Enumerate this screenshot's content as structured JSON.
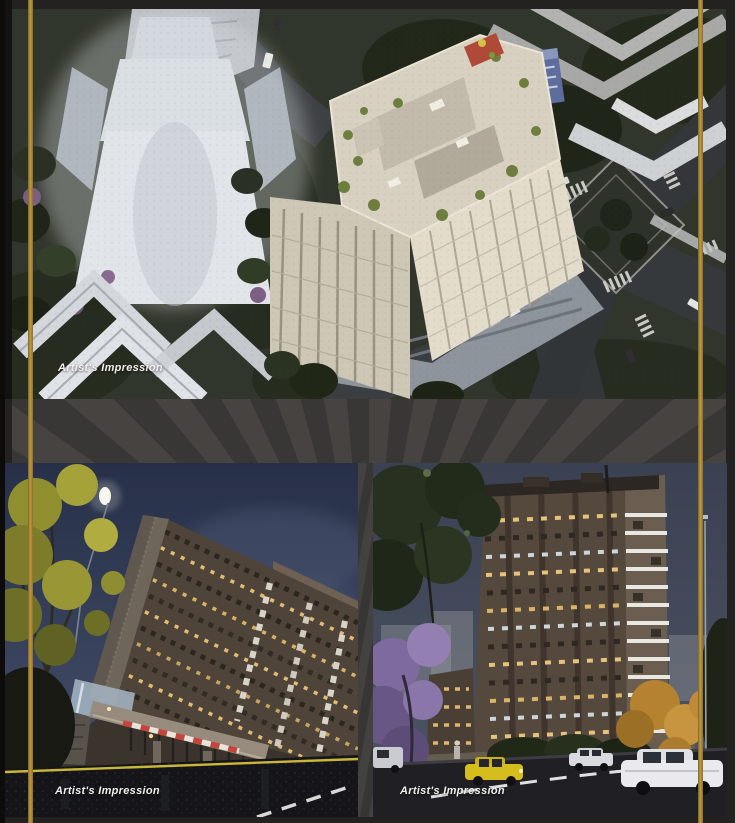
{
  "page": {
    "width": 735,
    "height": 823
  },
  "colors": {
    "accent_gold": "#c09a3f",
    "page_background": "#242220",
    "caption_text": "#f0f0ee"
  },
  "figures": {
    "aerial": {
      "caption": "Artist's Impression"
    },
    "night_entrance": {
      "caption": "Artist's Impression"
    },
    "night_street": {
      "caption": "Artist's Impression"
    }
  }
}
